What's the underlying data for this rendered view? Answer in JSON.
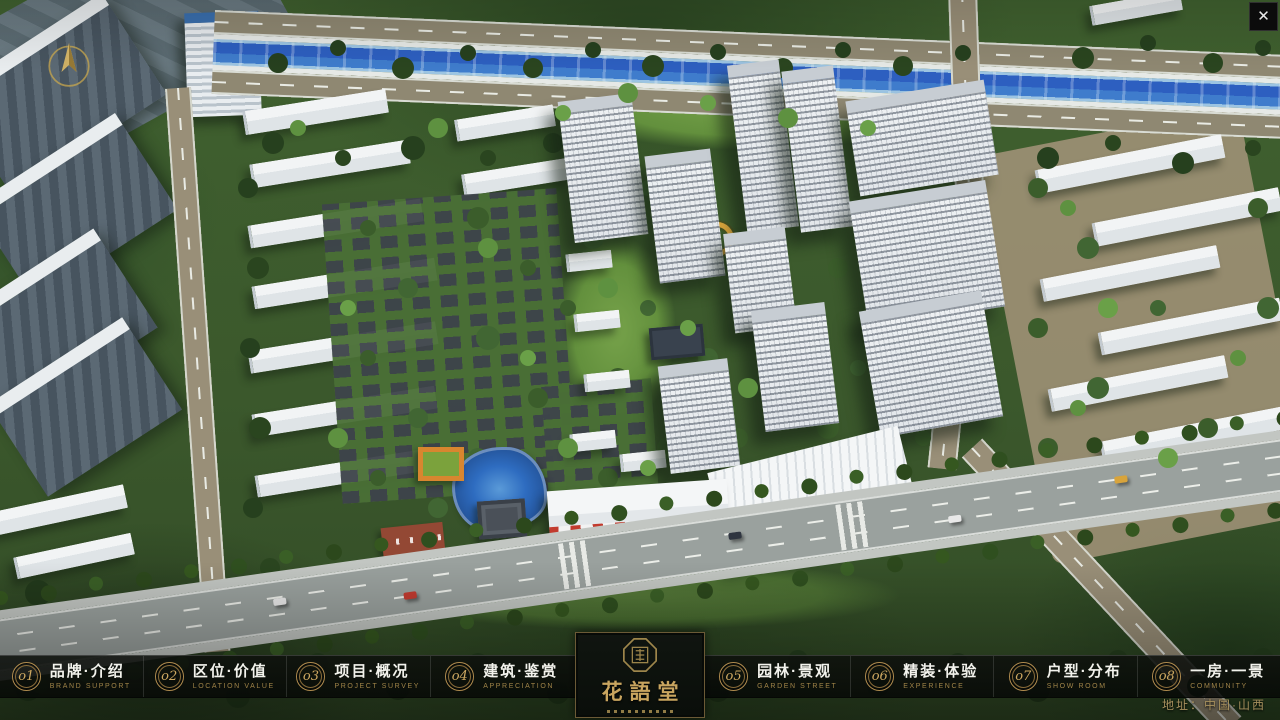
{
  "ui": {
    "close_glyph": "✕"
  },
  "logo": {
    "title": "花語堂"
  },
  "footer": {
    "address": "地址：中国·山西"
  },
  "colors": {
    "gold": "#c2a05f",
    "nav_bg": "#0a0d0a",
    "text_white": "#f2f2ec",
    "river_blue": "#2f62c2",
    "accent_red": "#c23b2e"
  },
  "nav": {
    "items": [
      {
        "num": "o1",
        "zh": "品牌·介绍",
        "en": "BRAND SUPPORT"
      },
      {
        "num": "o2",
        "zh": "区位·价值",
        "en": "LOCATION VALUE"
      },
      {
        "num": "o3",
        "zh": "项目·概况",
        "en": "PROJECT SURVEY"
      },
      {
        "num": "o4",
        "zh": "建筑·鉴赏",
        "en": "APPRECIATION"
      },
      {
        "num": "o5",
        "zh": "园林·景观",
        "en": "GARDEN STREET"
      },
      {
        "num": "o6",
        "zh": "精装·体验",
        "en": "EXPERIENCE"
      },
      {
        "num": "o7",
        "zh": "户型·分布",
        "en": "SHOW ROOM"
      },
      {
        "num": "o8",
        "zh": "一房·一景",
        "en": "COMMUNITY"
      }
    ]
  }
}
